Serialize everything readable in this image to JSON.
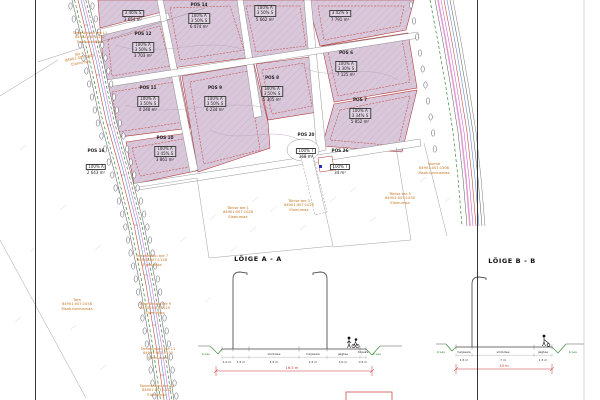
{
  "plan": {
    "plots": [
      {
        "name": "POS 12",
        "use": "100% Ä",
        "ratio": "3 50% S",
        "area": "3 703 m²"
      },
      {
        "name": "POS 14",
        "use": "100% Ä",
        "ratio": "3 50% S",
        "area": "6 474 m²"
      },
      {
        "name": "POS 11",
        "use": "100% Ä",
        "ratio": "3 50% S",
        "area": "4 240 m²"
      },
      {
        "name": "POS 9",
        "use": "100% Ä",
        "ratio": "3 50% S",
        "area": "6 234 m²"
      },
      {
        "name": "POS 8",
        "use": "100% Ä",
        "ratio": "3 50% S",
        "area": "5 305 m²"
      },
      {
        "name": "POS 6",
        "use": "100% Ä",
        "ratio": "3 30% S",
        "area": "7 125 m²"
      },
      {
        "name": "POS 7",
        "use": "100% Ä",
        "ratio": "3 34% S",
        "area": "5 852 m²"
      },
      {
        "name": "POS 10",
        "use": "100% Ä",
        "ratio": "3 45% S",
        "area": "3 861 m²"
      },
      {
        "name": "POS 16",
        "use": "100% Ä",
        "ratio": "",
        "area": "2 643 m²"
      },
      {
        "name": "POS 20",
        "use": "100% T",
        "ratio": "",
        "area": "368 m²"
      },
      {
        "name": "POS 26",
        "use": "100% T",
        "ratio": "",
        "area": "34 m²"
      }
    ],
    "fragments": [
      {
        "line1": "3 46% S",
        "line2": "3 654 m²"
      },
      {
        "line1": "100% Ä",
        "line2": "3 50% S",
        "line3": "5 662 m²"
      },
      {
        "line1": "3 42% S",
        "line2": "7 791 m²"
      }
    ],
    "cadastral_labels": [
      {
        "lines": [
          "Jõe 4",
          "84901:007:0305",
          "Elamumaa"
        ]
      },
      {
        "lines": [
          "Tammõniidu tee L1",
          "84901:007:1132",
          "Transpordimaa"
        ]
      },
      {
        "lines": [
          "Tara",
          "84901:007:1058",
          "Maatulundusmaa"
        ]
      },
      {
        "lines": [
          "Tammõniidu tee 7",
          "84901:007:1128",
          "Elamumaa"
        ]
      },
      {
        "lines": [
          "Tammõniidu tee 9",
          "84901:007:1129",
          "Elamumaa"
        ]
      },
      {
        "lines": [
          "Tammõniidu tee 11",
          "84901:007:1130",
          "Elamumaa"
        ]
      },
      {
        "lines": [
          "Tammõniidu tee 13",
          "84901:007:1131",
          "Elamumaa"
        ]
      },
      {
        "lines": [
          "Tõnise tee 1",
          "84901:007:1028",
          "Elamumaa"
        ]
      },
      {
        "lines": [
          "Tõnise tee 3",
          "84901:007:1029",
          "Elamumaa"
        ]
      },
      {
        "lines": [
          "Tõnise tee 5",
          "84901:007:1030",
          "Elamumaa"
        ]
      },
      {
        "lines": [
          "Nurme",
          "84901:007:1308",
          "Maatulundusmaa"
        ]
      }
    ]
  },
  "sections": {
    "a": {
      "title": "LÕIGE A - A",
      "segments": [
        {
          "label": "kraav",
          "dim": ""
        },
        {
          "label": "",
          "dim": "1,0 m"
        },
        {
          "label": "",
          "dim": "1,5 m"
        },
        {
          "label": "sõidutee",
          "dim": "4,5 m"
        },
        {
          "label": "haljasala",
          "dim": "2,5 m"
        },
        {
          "label": "jalgtee",
          "dim": "3,0 m"
        },
        {
          "label": "haljasala",
          "dim": "0,5 m"
        },
        {
          "label": "kraav",
          "dim": ""
        }
      ],
      "total": "16,5 m"
    },
    "b": {
      "title": "LÕIGE B - B",
      "segments": [
        {
          "label": "kraav",
          "dim": ""
        },
        {
          "label": "haljasala",
          "dim": "1,5 m"
        },
        {
          "label": "sõidutee",
          "dim": "7 m"
        },
        {
          "label": "jalgtee",
          "dim": "1,5 m"
        },
        {
          "label": "kraav",
          "dim": ""
        }
      ],
      "total": "10 m"
    }
  },
  "colors": {
    "plot_fill": "#d9c7da",
    "boundary_red": "#b03030",
    "cadastral_orange": "#c4731f",
    "vegetation_green": "#3a8a3a",
    "dimension_red": "#cc3333",
    "utility_blue": "#3366cc",
    "utility_magenta": "#cc44cc"
  }
}
